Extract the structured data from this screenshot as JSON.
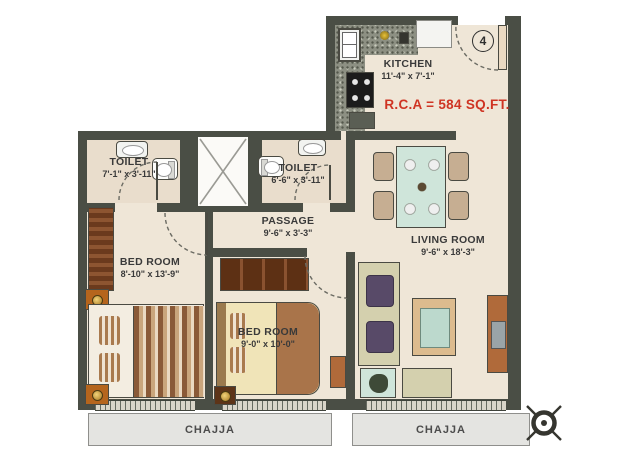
{
  "plan": {
    "flat_number": "4",
    "area_label": "R.C.A = 584 SQ.FT.",
    "rooms": [
      {
        "id": "kitchen",
        "name": "KITCHEN",
        "dimensions": "11'-4\" x 7'-1\""
      },
      {
        "id": "toilet-1",
        "name": "TOILET",
        "dimensions": "7'-1\" x 3'-11\""
      },
      {
        "id": "toilet-2",
        "name": "TOILET",
        "dimensions": "6'-6\" x 3'-11\""
      },
      {
        "id": "passage",
        "name": "PASSAGE",
        "dimensions": "9'-6\" x 3'-3\""
      },
      {
        "id": "living",
        "name": "LIVING ROOM",
        "dimensions": "9'-6\" x 18'-3\""
      },
      {
        "id": "bedroom-1",
        "name": "BED ROOM",
        "dimensions": "8'-10\" x 13'-9\""
      },
      {
        "id": "bedroom-2",
        "name": "BED ROOM",
        "dimensions": "9'-0\" x 10'-0\""
      }
    ],
    "balconies": [
      {
        "id": "chajja-left",
        "label": "CHAJJA"
      },
      {
        "id": "chajja-right",
        "label": "CHAJJA"
      }
    ],
    "colors": {
      "wall": "#4a4e45",
      "floor": "#efe6d7",
      "area_text": "#cf3423",
      "label_text": "#3a3a3a",
      "chajja_fill": "#e4e4e1"
    }
  }
}
